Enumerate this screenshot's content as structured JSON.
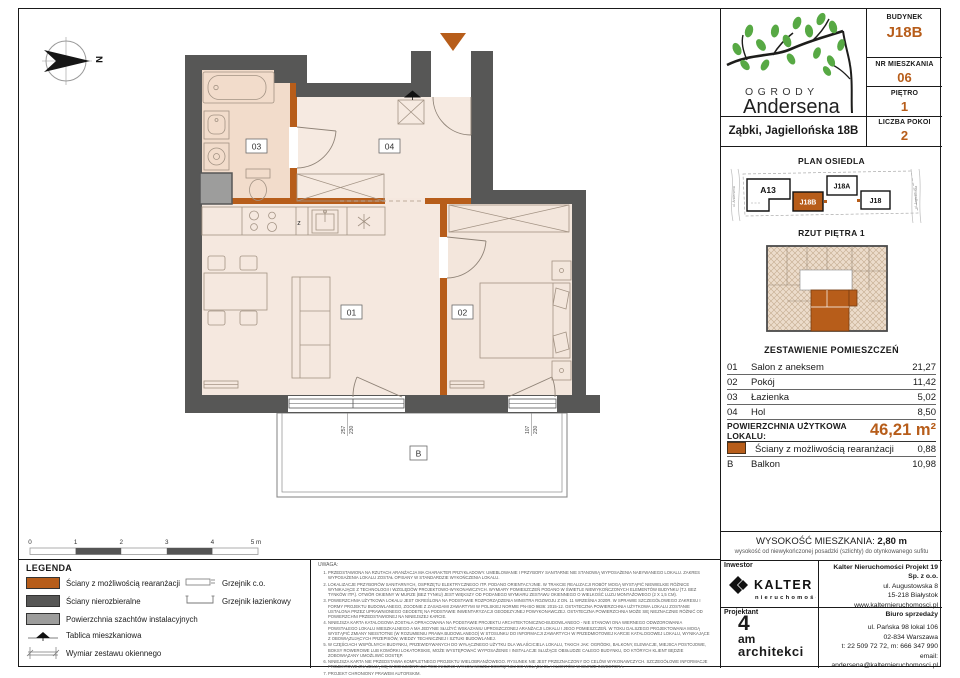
{
  "accent_color": "#b75d1a",
  "wall_color": "#575756",
  "shaft_color": "#9d9d9c",
  "header": {
    "budynek_label": "BUDYNEK",
    "budynek": "J18B",
    "nr_label": "NR MIESZKANIA",
    "nr": "06",
    "pietro_label": "PIĘTRO",
    "pietro": "1",
    "pokoje_label": "LICZBA POKOI",
    "pokoje": "2"
  },
  "logo": {
    "name_top": "OGRODY",
    "name_bottom": "Andersena",
    "address": "Ząbki, Jagiellońska 18B"
  },
  "site": {
    "title": "PLAN OSIEDLA",
    "street_left": "ul. Andersena",
    "street_right": "ul. Jagiellońska",
    "buildings": [
      "A13",
      "J18B",
      "J18A",
      "J18"
    ]
  },
  "rzut": {
    "title": "RZUT PIĘTRA 1"
  },
  "rooms": {
    "title": "ZESTAWIENIE POMIESZCZEŃ",
    "rows": [
      {
        "no": "01",
        "name": "Salon z aneksem",
        "area": "21,27"
      },
      {
        "no": "02",
        "name": "Pokój",
        "area": "11,42"
      },
      {
        "no": "03",
        "name": "Łazienka",
        "area": "5,02"
      },
      {
        "no": "04",
        "name": "Hol",
        "area": "8,50"
      }
    ],
    "total_label": "POWIERZCHNIA UŻYTKOWA LOKALU:",
    "total_value": "46,21 m²",
    "extra": [
      {
        "name": "Ściany z możliwością rearanżacji",
        "area": "0,88"
      },
      {
        "no": "B",
        "name": "Balkon",
        "area": "10,98"
      }
    ]
  },
  "height": {
    "label": "WYSOKOŚĆ MIESZKANIA:",
    "value": "2,80 m",
    "note": "wysokość od niewykończonej posadzki (szlichty) do otynkowanego sufitu"
  },
  "investor": {
    "label": "Inwestor",
    "brand": "KALTER",
    "brand_sub": "nieruchomości",
    "company": "Kalter Nieruchomości Projekt 19 Sp. z o.o.",
    "addr1": "ul. Augustowska 8",
    "addr2": "15-218 Białystok",
    "www": "www.kalternieruchomosci.pl"
  },
  "designer": {
    "label": "Projektant",
    "line1": "4",
    "line2": "am",
    "line3": "architekci"
  },
  "sales": {
    "label": "Biuro sprzedaży",
    "addr1": "ul. Pańska 98 lokal 106",
    "addr2": "02-834 Warszawa",
    "phone": "t: 22 509 72 72, m: 666 347 990",
    "email": "email: andersena@kalternieruchomosci.pl"
  },
  "legend": {
    "title": "LEGENDA",
    "items": [
      {
        "label": "Ściany z możliwością rearanżacji"
      },
      {
        "label": "Ściany nierozbieralne"
      },
      {
        "label": "Powierzchnia szachtów instalacyjnych"
      },
      {
        "label": "Tablica mieszkaniowa"
      },
      {
        "label": "Wymiar zestawu okiennego"
      }
    ],
    "radiators": [
      {
        "label": "Grzejnik c.o."
      },
      {
        "label": "Grzejnik łazienkowy"
      }
    ]
  },
  "plan": {
    "north_label": "N",
    "room_labels": {
      "r01": "01",
      "r02": "02",
      "r03": "03",
      "r04": "04"
    },
    "balcony_label": "B",
    "kitchen_sink_label": "z",
    "window_dims": [
      {
        "w": "257",
        "h": "230"
      },
      {
        "w": "107",
        "h": "230"
      }
    ],
    "scale": [
      "0",
      "1",
      "2",
      "3",
      "4",
      "5 m"
    ]
  },
  "notes": {
    "title": "UWAGA:",
    "items": [
      "PRZEDSTAWIONA NA RZUTACH ARANŻACJA MA CHARAKTER PRZYKŁADOWY. UMEBLOWANIE I PRZYBORY SANITARNE NIE STANOWIĄ WYPOSAŻENIA NABYWANEGO LOKALU. ZAKRES WYPOSAŻENIA LOKALU ZOSTAŁ OPISANY W STANDARDZIE WYKOŃCZENIA LOKALU.",
      "LOKALIZACJE PRZYBORÓW SANITARNYCH, OSPRZĘTU ELEKTRYCZNEGO ITP. PODANO ORIENTACYJNIE. W TRAKCIE REALIZACJI ROBÓT MOGĄ WYSTĄPIĆ NIEWIELKIE RÓŻNICE WYNIKAJĄCE Z TECHNOLOGII I WZGLĘDÓW PROJEKTOWO-WYKONAWCZYCH. WYMIARY POMIESZCZEŃ PODANO W ŚWIETLE NIEWYKOŃCZONYCH ELEMENTÓW BUDYNKU (TJ. BEZ TYNKÓW ITP.). OTWÓR OKIENNY W MURZE (BEZ TYNKU) JEST WIĘKSZY OD PODANEGO WYMIARU ZESTAWU OKIENNEGO O WIELKOŚĆ LUZU MONTAŻOWEGO (2 X 1,5 CM).",
      "POWIERZCHNIA UŻYTKOWA LOKALU JEST OKREŚLONA NA PODSTAWIE ROZPORZĄDZENIA MINISTRA ROZWOJU Z DN. 11 WRZEŚNIA 2020R. W SPRAWIE SZCZEGÓŁOWEGO ZAKRESU I FORMY PROJEKTU BUDOWLANEGO, ZGODNIE Z ZASADAMI ZAWARTYMI W POLSKIEJ NORMIE PN-ISO 9836: 2015-12. OSTATECZNA POWIERZCHNIA UŻYTKOWA LOKALU ZOSTANIE USTALONA PRZEZ UPRAWNIONEGO GEODETĘ NA PODSTAWIE INWENTARYZACJI GEODEZYJNEJ POWYKONAWCZEJ. OSTATECZNA POWIERZCHNIA MOŻE SIĘ NIEZNACZNIE RÓŻNIĆ OD POWIERZCHNI PRZEDSTAWIONEJ NA NINIEJSZEJ KARCIE.",
      "NINIEJSZA KARTA KATALOGOWA ZOSTAŁA OPRACOWANA NA PODSTAWIE PROJEKTU ARCHITEKTONICZNO-BUDOWLANEGO - NIE STANOWI ONA WIERNEGO ODWZOROWANIA POWSTAŁEGO LOKALU MIESZKALNEGO A MA JEDYNIE SŁUŻYĆ WSKAZANIU UPROSZCZONEJ ARANŻACJI LOKALU I JEGO POMIESZCZEŃ. W TOKU DALSZEGO PROJEKTOWANIA MOGĄ WYSTĄPIĆ ZMIANY NIEISTOTNE (W ROZUMIENIU PRAWA BUDOWLANEGO) W STOSUNKU DO INFORMACJI ZAWARTYCH W PRZEDMIOTOWEJ KARCIE KATALOGOWEJ LOKALU, WYNIKAJĄCE Z OBOWIĄZUJĄCYCH PRZEPISÓW, WIEDZY TECHNICZNEJ I SZTUKI BUDOWLANEJ.",
      "W CZĘŚCIACH WSPÓLNYCH BUDYNKU, PRZEWIDYWANYCH DO WYŁĄCZNEGO UŻYTKU DLA WŁAŚCICIELA LOKALU, TAKICH JAK: OGRÓDKI, BALKONY, ELEWACJE, MIEJSCA POSTOJOWE, BOKSY ROWEROWE LUB KOMÓRKI LOKATORSKIE, MOŻE WYSTĘPOWAĆ WYPOSAŻENIE I INSTALACJE SŁUŻĄCE OBSŁUDZE CAŁEGO BUDYNKU, DO KTÓRYCH KLIENT BĘDZIE ZOBOWIĄZANY UMOŻLIWIĆ DOSTĘP.",
      "NINIEJSZA KARTA NIE PRZEDSTAWIA KOMPLETNEGO PROJEKTU WIELOBRANŻOWEGO. RYSUNEK NIE JEST PRZEZNACZONY DO CELÓW WYKONAWCZYCH. SZCZEGÓŁOWE INFORMACJE PROJEKTOWE ZNAJDUJĄ SIĘ W DOKUMENTACJI TECHNICZNO-WYKONAWCZEJ DOSTĘPNEJ DO WGLĄDU DLA KLIENTÓW W BIURZE INWESTORA.",
      "PROJEKT CHRONIONY PRAWEM AUTORSKIM."
    ]
  }
}
